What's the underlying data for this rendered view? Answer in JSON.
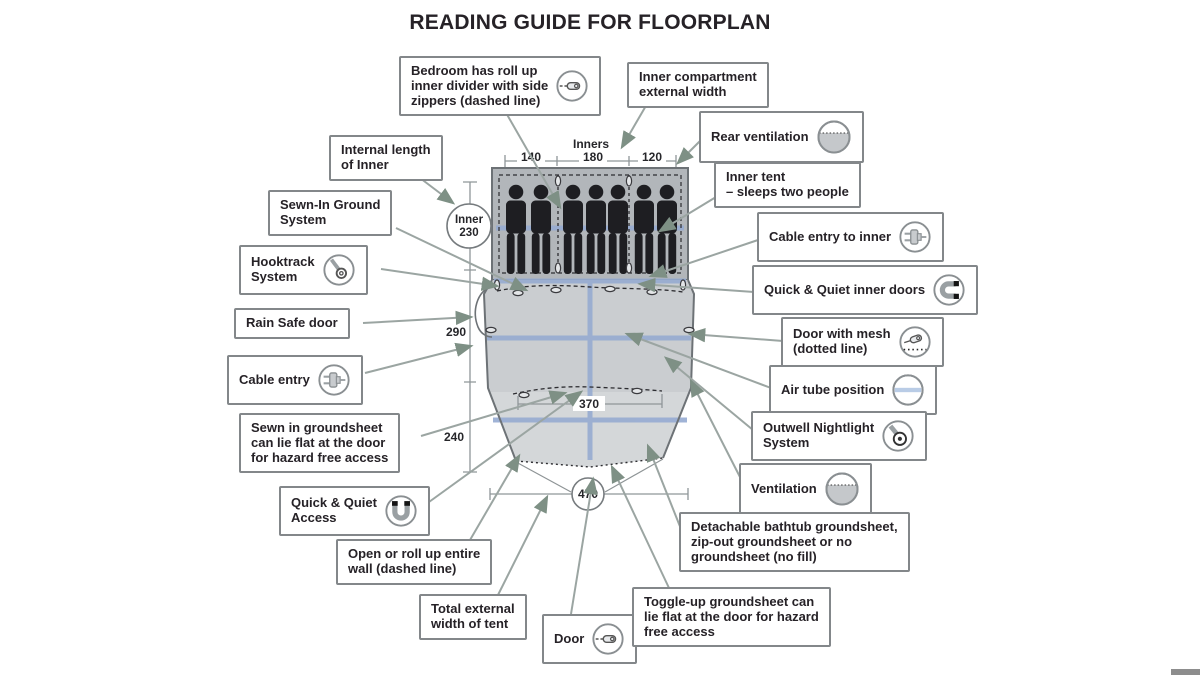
{
  "title": "READING GUIDE FOR FLOORPLAN",
  "floorplan": {
    "inners_label": "Inners",
    "top_widths": [
      "140",
      "180",
      "120"
    ],
    "inner_circle": {
      "line1": "Inner",
      "line2": "230"
    },
    "left_depths": {
      "living": "290",
      "front": "240"
    },
    "door_width": "370",
    "total_width": "470",
    "sleeper_count": 7
  },
  "callouts_left": [
    {
      "label": "Bedroom has roll up\ninner divider with side\nzippers (dashed line)",
      "icon": "zipper-icon"
    },
    {
      "label": "Internal length\nof Inner",
      "icon": null
    },
    {
      "label": "Sewn-In Ground\nSystem",
      "icon": null
    },
    {
      "label": "Hooktrack\nSystem",
      "icon": "hook-icon"
    },
    {
      "label": "Rain Safe door",
      "icon": null
    },
    {
      "label": "Cable entry",
      "icon": "plug-icon"
    },
    {
      "label": "Sewn in groundsheet\ncan lie flat at the door\nfor hazard free access",
      "icon": null
    },
    {
      "label": "Quick & Quiet\nAccess",
      "icon": "magnet-icon"
    },
    {
      "label": "Open or roll up entire\nwall (dashed line)",
      "icon": null
    },
    {
      "label": "Total external\nwidth of tent",
      "icon": null
    },
    {
      "label": "Door",
      "icon": "zipper-icon"
    }
  ],
  "callouts_right": [
    {
      "label": "Inner compartment\nexternal width",
      "icon": null
    },
    {
      "label": "Rear ventilation",
      "icon": "ventilation-icon"
    },
    {
      "label": "Inner tent\n– sleeps two people",
      "icon": null
    },
    {
      "label": "Cable entry to inner",
      "icon": "plug-icon"
    },
    {
      "label": "Quick & Quiet inner doors",
      "icon": "magnet-icon"
    },
    {
      "label": "Door with mesh\n(dotted line)",
      "icon": "zipper-mesh-icon"
    },
    {
      "label": "Air tube position",
      "icon": "air-tube-icon"
    },
    {
      "label": "Outwell Nightlight\nSystem",
      "icon": "nightlight-icon"
    },
    {
      "label": "Ventilation",
      "icon": "ventilation-icon"
    },
    {
      "label": "Detachable bathtub groundsheet,\nzip-out groundsheet or no\ngroundsheet (no fill)",
      "icon": null
    },
    {
      "label": "Toggle-up groundsheet can\nlie flat at the door for hazard\nfree access",
      "icon": null
    }
  ],
  "colors": {
    "arrow": "#7e9085",
    "tube_blue": "#96abd1",
    "bedroom_fill": "#b2b6ba",
    "living_fill": "#cacdd0",
    "front_fill": "#d4d7d9",
    "figure": "#1e1e22",
    "box_border": "#83878a"
  }
}
